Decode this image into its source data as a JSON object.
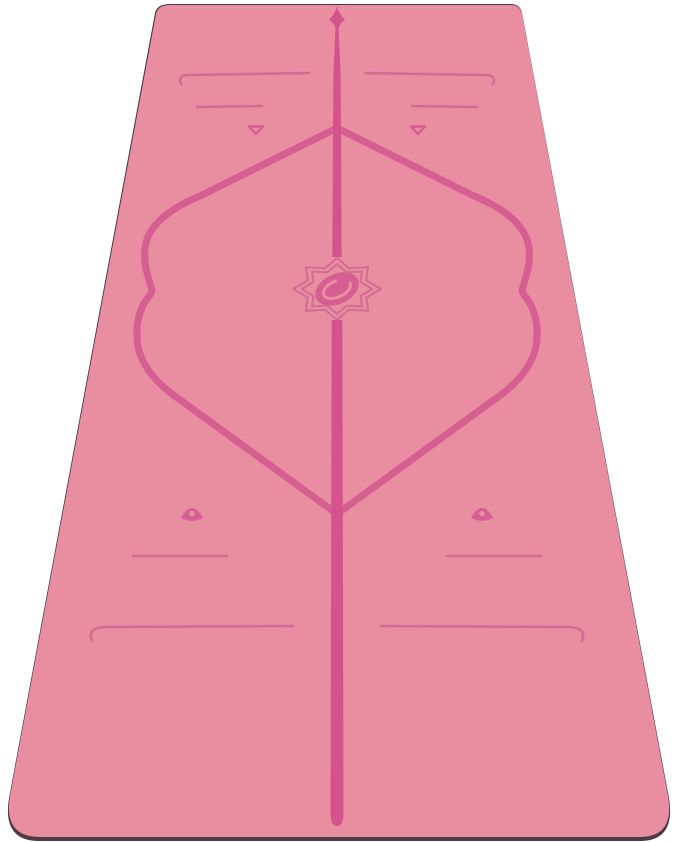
{
  "scene": {
    "type": "product-photo",
    "subject": "alignment yoga mat",
    "mat_color_name": "pink",
    "view": "top-down with slight perspective, top edge narrower than bottom",
    "background": "plain white"
  },
  "colors": {
    "background": "#ffffff",
    "mat": "#e98da1",
    "marking": "#d45f90",
    "marking-bold": "#d4538c",
    "marking-thin": "#d16d92",
    "mat-edge-dark": "#4d3b44"
  },
  "markings": {
    "center_line": "tapered vertical center line, arrow tip at top, rounded end near bottom edge",
    "top_arrow": "four-point spear/arrow tip at top of center line",
    "alignment_frame": "large diamond outline with wavy hand-placement curves on left and right sides",
    "emblem": "lotus flower double outline with oval pebble logo at mat center",
    "top_guides": "two long end-hooked horizontal lines, two short lines, two small outlined down-pointing triangles",
    "bottom_guides": "two filled up-pointing triangles with center holes, two short lines, two long end-hooked lines"
  }
}
